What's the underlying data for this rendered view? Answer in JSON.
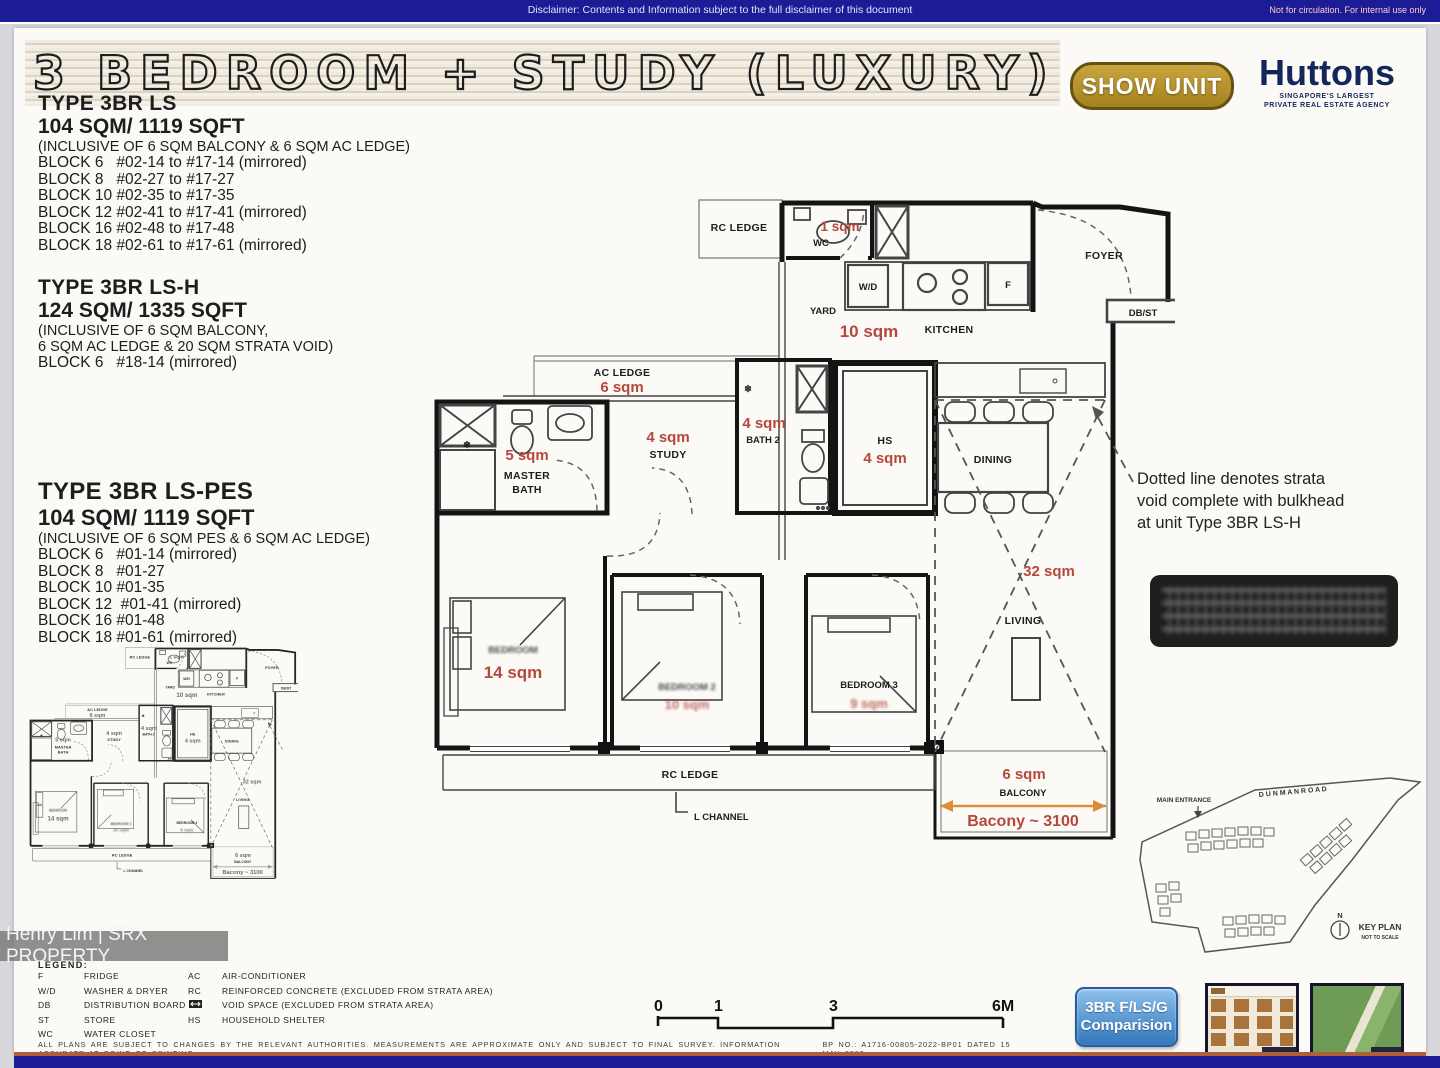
{
  "topbar": {
    "disclaimer": "Disclaimer: Contents and Information subject to the full disclaimer of this document",
    "internal": "Not for circulation. For internal use only"
  },
  "header": {
    "title": "3 BEDROOM + STUDY (LUXURY)",
    "show_unit": "SHOW UNIT",
    "huttons": "Huttons",
    "huttons_tag1": "SINGAPORE'S LARGEST",
    "huttons_tag2": "PRIVATE REAL ESTATE AGENCY"
  },
  "type1": {
    "name": "TYPE 3BR LS",
    "area": "104 SQM/ 1119 SQFT",
    "inc1": "(INCLUSIVE OF 6 SQM BALCONY & 6 SQM AC LEDGE)",
    "blocks": [
      "BLOCK 6   #02-14 to #17-14 (mirrored)",
      "BLOCK 8   #02-27 to #17-27",
      "BLOCK 10 #02-35 to #17-35",
      "BLOCK 12 #02-41 to #17-41 (mirrored)",
      "BLOCK 16 #02-48 to #17-48",
      "BLOCK 18 #02-61 to #17-61 (mirrored)"
    ]
  },
  "type2": {
    "name": "TYPE 3BR LS-H",
    "area": "124 SQM/ 1335 SQFT",
    "inc1": "(INCLUSIVE OF 6 SQM BALCONY,",
    "inc2": "6 SQM AC LEDGE & 20 SQM STRATA VOID)",
    "blocks": [
      "BLOCK 6   #18-14 (mirrored)"
    ]
  },
  "type3": {
    "name": "TYPE 3BR LS-PES",
    "area": "104 SQM/ 1119 SQFT",
    "inc1": "(INCLUSIVE OF 6 SQM PES & 6 SQM AC LEDGE)",
    "blocks": [
      "BLOCK 6   #01-14 (mirrored)",
      "BLOCK 8   #01-27",
      "BLOCK 10 #01-35",
      "BLOCK 12  #01-41 (mirrored)",
      "BLOCK 16 #01-48",
      "BLOCK 18 #01-61 (mirrored)"
    ]
  },
  "plan": {
    "rc_top": "RC LEDGE",
    "wc_sqm": "1 sqm",
    "wc": "WC",
    "wd": "W/D",
    "f": "F",
    "yard": "YARD",
    "yard_sqm": "10 sqm",
    "kitchen": "KITCHEN",
    "foyer": "FOYER",
    "dbst": "DB/ST",
    "ac_ledge": "AC LEDGE",
    "ac_sqm": "6 sqm",
    "mb_sqm": "5 sqm",
    "mb1": "MASTER",
    "mb2": "BATH",
    "study_sqm": "4 sqm",
    "study": "STUDY",
    "b2_sqm": "4 sqm",
    "b2": "BATH 2",
    "hs": "HS",
    "hs_sqm": "4 sqm",
    "dining": "DINING",
    "void_sqm": "32 sqm",
    "living": "LIVING",
    "mbr": "BEDROOM",
    "mbr_sqm": "14 sqm",
    "br2": "BEDROOM 2",
    "br2_sqm": "10 sqm",
    "br3": "BEDROOM 3",
    "br3_sqm": "9 sqm",
    "rc_bottom": "RC LEDGE",
    "lchannel": "L CHANNEL",
    "bal_sqm": "6 sqm",
    "balcony": "BALCONY",
    "bal_dim": "Bacony ~ 3100",
    "snow": "❄"
  },
  "note": {
    "l1": "Dotted line denotes strata",
    "l2": "void complete with bulkhead",
    "l3": "at unit Type 3BR LS-H"
  },
  "legend": {
    "heading": "LEGEND:",
    "col1": [
      {
        "abbr": "F",
        "term": "FRIDGE"
      },
      {
        "abbr": "W/D",
        "term": "WASHER  &  DRYER"
      },
      {
        "abbr": "DB",
        "term": "DISTRIBUTION  BOARD"
      },
      {
        "abbr": "ST",
        "term": "STORE"
      },
      {
        "abbr": "WC",
        "term": "WATER CLOSET"
      }
    ],
    "col2": [
      {
        "abbr": "AC",
        "term": "AIR-CONDITIONER"
      },
      {
        "abbr": "RC",
        "term": "REINFORCED CONCRETE (EXCLUDED FROM STRATA AREA)"
      },
      {
        "abbr": "",
        "term": "VOID SPACE (EXCLUDED FROM STRATA AREA)"
      },
      {
        "abbr": "HS",
        "term": "HOUSEHOLD SHELTER"
      }
    ]
  },
  "scalebar": {
    "n0": "0",
    "n1": "1",
    "n3": "3",
    "n6": "6M"
  },
  "footer": {
    "disclaimer": "ALL  PLANS  ARE  SUBJECT  TO  CHANGES  BY  THE  RELEVANT  AUTHORITIES.    MEASUREMENTS  ARE  APPROXIMATE  ONLY  AND SUBJECT  TO  FINAL  SURVEY.    INFORMATION  ACCURATE  AT  POINT  OF  PRINTING.",
    "bp": "BP  NO.:  A1716-00805-2022-BP01  DATED  15  MAY  2023"
  },
  "keyplan": {
    "entrance": "MAIN ENTRANCE",
    "road": "D U N M A N    R O A D",
    "north": "N",
    "title": "KEY PLAN",
    "scale": "NOT TO SCALE"
  },
  "watermark": "Henry Lim | SRX PROPERTY",
  "comparison": {
    "l1": "3BR F/LS/G",
    "l2": "Comparision"
  },
  "colors": {
    "red": "#b5483c",
    "orange": "#dd8d3a",
    "navy": "#1c1c96",
    "gold": "#b3922f"
  }
}
